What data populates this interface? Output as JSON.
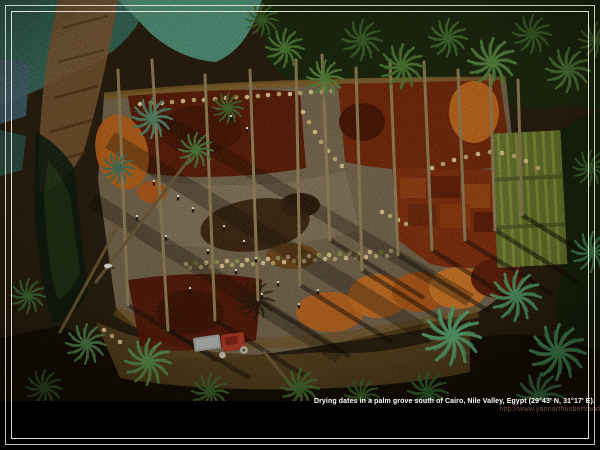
{
  "caption": {
    "title": "Drying dates in a palm grove south of Cairo, Nile Valley, Egypt (29°43' N, 31°17' E).",
    "url": "http://www.yannarthusbertrand.org"
  },
  "colors": {
    "frame": "#f2f0e8",
    "caption_text": "#ffffff",
    "caption_url": "#7d4f43",
    "field_teal": "#4c8a72",
    "date_maroon": "#551905",
    "date_rust": "#7c2a0a",
    "date_orange": "#bc6418",
    "clearing_ground": "#70624a",
    "palm_green": "#4e7834",
    "tractor_red": "#a83322",
    "basket_cream": "#d9c28c"
  }
}
